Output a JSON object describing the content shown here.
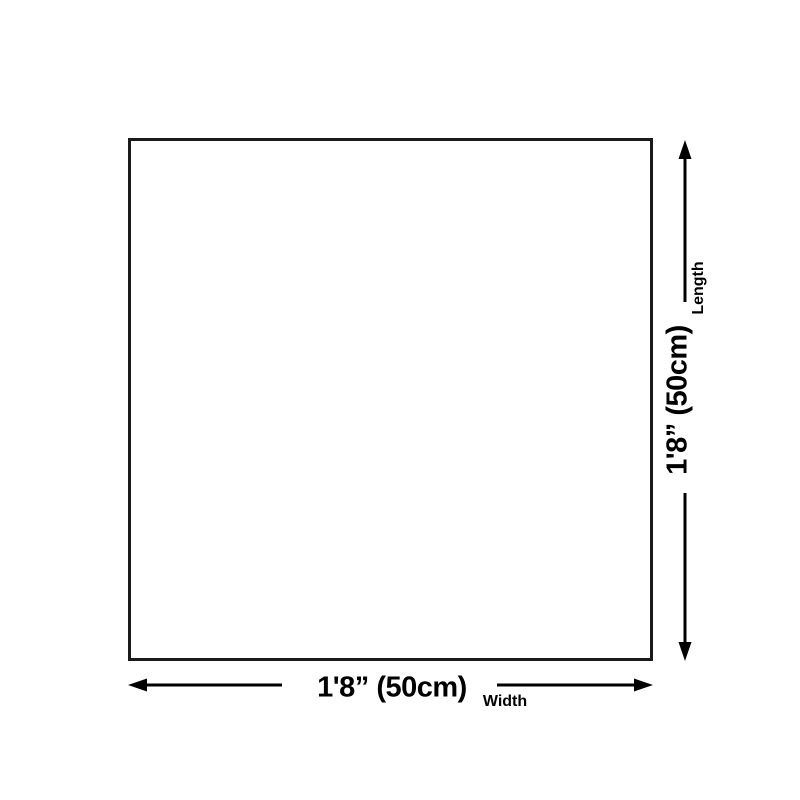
{
  "page": {
    "background_color": "#ffffff"
  },
  "diagram": {
    "type": "product-size-diagram",
    "outline_color": "#1a1a1a",
    "line_color": "#000000",
    "text_color": "#000000",
    "width_dimension": {
      "value": "1'8” (50cm)",
      "axis_label": "Width"
    },
    "length_dimension": {
      "value": "1'8” (50cm)",
      "axis_label": "Length"
    }
  }
}
